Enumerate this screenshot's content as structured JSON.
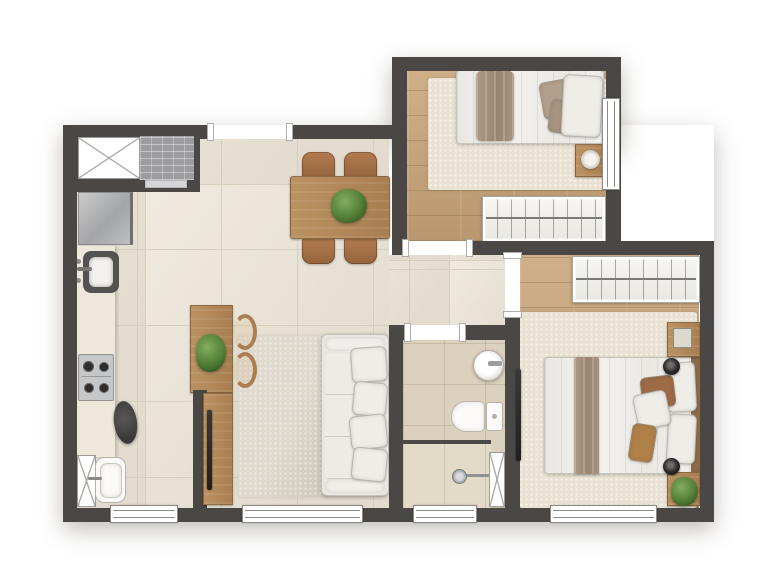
{
  "palette": {
    "wall": "#4a4745",
    "tile": "#eae3d5",
    "tileLine": "#d7cfbe",
    "bathFloor": "#dcd1bd",
    "showerFloor": "#e3dac8",
    "wood": "#c7a377",
    "rugCream": "#e9e2d2",
    "rugLiving": "#d6cfc1",
    "counter": "#ede8db",
    "fabric": "#efede8",
    "brick": "#9d9da0",
    "windowLine": "#8d8b87",
    "plantGreen": "#527d35",
    "accentBrown": "#a06f44",
    "steelGray": "#b4b5b8",
    "tvBlack": "#2d2c2b"
  },
  "plan": {
    "type": "apartment-floor-plan",
    "view": "top-down-render",
    "rooms": [
      {
        "name": "kitchen-laundry",
        "items": [
          "utility-shaft",
          "grill-area",
          "refrigerator",
          "countertop",
          "kitchen-sink",
          "cooktop",
          "stool",
          "laundry-tank",
          "laundry-shaft",
          "window"
        ]
      },
      {
        "name": "living-dining",
        "items": [
          "entry-opening",
          "dining-table",
          "dining-chair x4",
          "centerpiece-plant",
          "desk",
          "desk-plant",
          "desk-chair x2",
          "half-wall",
          "tv-panel",
          "tv",
          "sofa",
          "rug",
          "window"
        ]
      },
      {
        "name": "bedroom-small",
        "items": [
          "single-bed",
          "blanket",
          "pillows",
          "rug",
          "nightstand",
          "table-lamp",
          "wardrobe",
          "window",
          "door"
        ]
      },
      {
        "name": "hallway",
        "items": [
          "door-to-bedroom",
          "door-to-bathroom",
          "door-to-master"
        ]
      },
      {
        "name": "bathroom",
        "items": [
          "washbasin",
          "faucet",
          "toilet",
          "shower-partition",
          "shower-head",
          "utility-shaft",
          "window",
          "door"
        ]
      },
      {
        "name": "master-bedroom",
        "items": [
          "double-bed",
          "blanket",
          "pillows",
          "headboard",
          "bedside-lamp x2",
          "nightstand x2",
          "plant",
          "wardrobe",
          "rug",
          "wall-tv",
          "window",
          "door"
        ]
      }
    ],
    "window_count": 5,
    "door_opening_count": 4
  }
}
